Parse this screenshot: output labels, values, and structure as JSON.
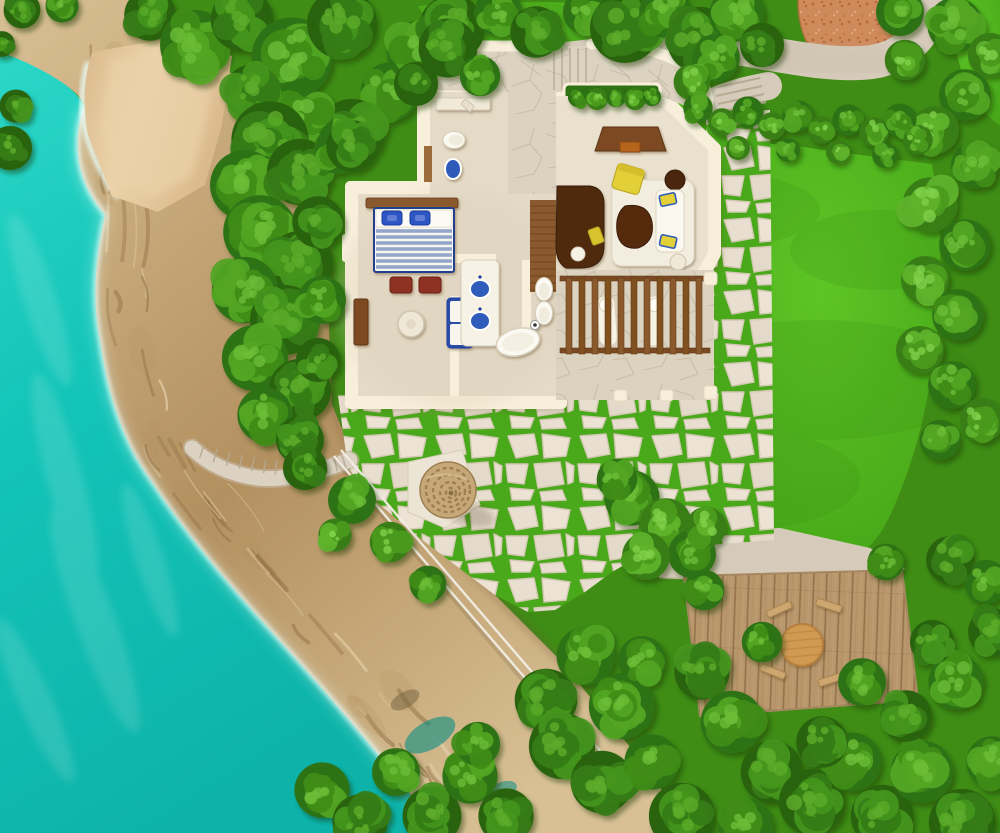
{
  "labels": {
    "scene": "aerial-villa-site-plan",
    "sea": "turquoise sea",
    "beach": "sand beach cove",
    "cliff": "rocky cliff shoreline",
    "forest": "tree canopy",
    "lawn": "green lawn",
    "gravel": "terracotta gravel court",
    "path": "concrete garden path",
    "flagstone": "flagstone walk with grass joints",
    "villa": "villa floor plan",
    "bedroom": "bedroom",
    "bathroom": "bathroom",
    "living": "living room",
    "courtyard": "entry courtyard",
    "pergola": "pergola sun deck",
    "umbrella": "thatched sun umbrella",
    "deck": "wooden dining deck",
    "stairs": "cliff stairway",
    "railing": "cliff handrail"
  },
  "palette": {
    "water-a": "#2bd7c7",
    "water-b": "#14c4b8",
    "water-c": "#0db3a9",
    "foam": "#eafffb",
    "sand-a": "#ecd2a9",
    "sand-b": "#d9b98c",
    "rock-a": "#d8c094",
    "rock-b": "#b3905f",
    "rock-dark": "#8c6b41",
    "rock-light": "#eeddbb",
    "grass-base": "#3f8d15",
    "lawn-a": "#5ec526",
    "lawn-b": "#42a115",
    "lawn-dim": "#2f7d0e",
    "joint": "#4aa81b",
    "stone": "#e8dfd0",
    "stone-edge": "#d5c9b4",
    "concrete": "#d6cbba",
    "concrete-edge": "#b7aa94",
    "terra": "#cf8a5c",
    "terra-dark": "#b4683a",
    "terra-light": "#e3a877",
    "wall-cream": "#f7efda",
    "wall-edge": "#e7dbc0",
    "floor": "#e4dac6",
    "floor-light": "#e9e0cd",
    "stonefloor": "#dcd2c0",
    "wood": "#8a5a2e",
    "wood-dark": "#633c17",
    "wood-mid": "#7b4a22",
    "plank-a": "#c19e74",
    "plank-b": "#8f6d45",
    "table-wood": "#d09a52",
    "thatch": "#c6a878",
    "thatch-ring": "#9e7f52",
    "navy": "#24418f",
    "stripe-blue": "#93a5c9",
    "pillow-blue": "#2e55c4",
    "sink-blue": "#2d5cb8",
    "fixture": "#fbfaf2",
    "fixture-edge": "#d8cfbc",
    "yellow": "#e3cf39",
    "yellow-dark": "#b7a51f",
    "ottoman": "#8d3220",
    "darkwood": "#4f2a10",
    "rug": "#f4efe1",
    "white": "#ffffff"
  },
  "trees": [
    [
      150,
      15,
      28,
      0
    ],
    [
      195,
      45,
      38,
      1
    ],
    [
      242,
      20,
      34,
      0
    ],
    [
      292,
      58,
      44,
      1
    ],
    [
      342,
      24,
      38,
      0
    ],
    [
      390,
      92,
      32,
      1
    ],
    [
      352,
      132,
      36,
      0
    ],
    [
      302,
      118,
      34,
      1
    ],
    [
      252,
      92,
      30,
      0
    ],
    [
      418,
      52,
      34,
      1
    ],
    [
      452,
      28,
      36,
      0
    ],
    [
      498,
      12,
      26,
      1
    ],
    [
      536,
      32,
      28,
      0
    ],
    [
      585,
      12,
      24,
      1
    ],
    [
      625,
      28,
      38,
      0
    ],
    [
      665,
      12,
      28,
      1
    ],
    [
      700,
      40,
      36,
      0
    ],
    [
      737,
      14,
      30,
      1
    ],
    [
      762,
      45,
      24,
      0
    ],
    [
      270,
      140,
      42,
      0
    ],
    [
      245,
      185,
      38,
      1
    ],
    [
      300,
      172,
      36,
      0
    ],
    [
      260,
      232,
      40,
      1
    ],
    [
      300,
      264,
      36,
      0
    ],
    [
      245,
      290,
      36,
      1
    ],
    [
      285,
      320,
      38,
      0
    ],
    [
      255,
      358,
      36,
      1
    ],
    [
      300,
      390,
      34,
      0
    ],
    [
      265,
      415,
      30,
      1
    ],
    [
      318,
      222,
      28,
      0
    ],
    [
      322,
      300,
      26,
      1
    ],
    [
      318,
      360,
      24,
      0
    ],
    [
      338,
      150,
      26,
      1
    ],
    [
      300,
      440,
      26,
      0
    ],
    [
      352,
      146,
      28,
      0
    ],
    [
      448,
      48,
      32,
      0
    ],
    [
      480,
      76,
      22,
      1
    ],
    [
      416,
      84,
      24,
      0
    ],
    [
      10,
      148,
      24,
      0
    ],
    [
      16,
      106,
      18,
      0
    ],
    [
      22,
      10,
      20,
      0
    ],
    [
      62,
      6,
      18,
      1
    ],
    [
      2,
      44,
      14,
      0
    ],
    [
      900,
      12,
      26,
      1
    ],
    [
      955,
      25,
      30,
      1
    ],
    [
      990,
      55,
      24,
      2
    ],
    [
      965,
      95,
      28,
      1
    ],
    [
      935,
      130,
      26,
      2
    ],
    [
      975,
      165,
      26,
      1
    ],
    [
      930,
      205,
      30,
      2
    ],
    [
      965,
      245,
      28,
      1
    ],
    [
      925,
      280,
      26,
      2
    ],
    [
      958,
      315,
      28,
      1
    ],
    [
      920,
      350,
      26,
      2
    ],
    [
      952,
      385,
      26,
      1
    ],
    [
      982,
      420,
      24,
      2
    ],
    [
      940,
      440,
      22,
      1
    ],
    [
      905,
      60,
      22,
      2
    ],
    [
      716,
      58,
      26,
      1
    ],
    [
      692,
      82,
      20,
      2
    ],
    [
      698,
      108,
      16,
      1
    ],
    [
      722,
      122,
      15,
      2
    ],
    [
      748,
      112,
      17,
      1
    ],
    [
      772,
      126,
      15,
      2
    ],
    [
      798,
      116,
      17,
      1
    ],
    [
      822,
      130,
      15,
      2
    ],
    [
      848,
      120,
      17,
      1
    ],
    [
      874,
      132,
      16,
      2
    ],
    [
      900,
      120,
      18,
      1
    ],
    [
      738,
      148,
      13,
      2
    ],
    [
      788,
      150,
      13,
      1
    ],
    [
      838,
      152,
      13,
      2
    ],
    [
      885,
      155,
      14,
      1
    ],
    [
      918,
      140,
      16,
      2
    ],
    [
      632,
      498,
      30,
      1
    ],
    [
      666,
      524,
      28,
      2
    ],
    [
      692,
      554,
      26,
      1
    ],
    [
      646,
      556,
      26,
      2
    ],
    [
      617,
      479,
      22,
      1
    ],
    [
      706,
      527,
      22,
      2
    ],
    [
      704,
      590,
      22,
      1
    ],
    [
      352,
      500,
      26,
      1
    ],
    [
      390,
      542,
      22,
      2
    ],
    [
      428,
      584,
      20,
      1
    ],
    [
      305,
      468,
      24,
      0
    ],
    [
      335,
      535,
      18,
      2
    ],
    [
      578,
      97,
      11,
      1
    ],
    [
      597,
      99,
      12,
      2
    ],
    [
      616,
      97,
      11,
      1
    ],
    [
      635,
      99,
      12,
      2
    ],
    [
      652,
      97,
      10,
      1
    ],
    [
      322,
      790,
      30,
      1
    ],
    [
      360,
      822,
      30,
      0
    ],
    [
      396,
      772,
      26,
      1
    ],
    [
      432,
      816,
      32,
      0
    ],
    [
      470,
      776,
      30,
      1
    ],
    [
      506,
      816,
      30,
      0
    ],
    [
      478,
      744,
      24,
      1
    ],
    [
      546,
      700,
      34,
      0
    ],
    [
      586,
      656,
      32,
      1
    ],
    [
      562,
      746,
      36,
      0
    ],
    [
      622,
      706,
      36,
      1
    ],
    [
      602,
      782,
      34,
      0
    ],
    [
      652,
      762,
      30,
      1
    ],
    [
      682,
      816,
      36,
      0
    ],
    [
      642,
      660,
      26,
      1
    ],
    [
      702,
      672,
      30,
      0
    ],
    [
      732,
      722,
      34,
      1
    ],
    [
      772,
      772,
      34,
      0
    ],
    [
      746,
      826,
      30,
      1
    ],
    [
      812,
      802,
      36,
      0
    ],
    [
      852,
      762,
      32,
      1
    ],
    [
      882,
      816,
      34,
      0
    ],
    [
      922,
      772,
      34,
      1
    ],
    [
      962,
      822,
      36,
      0
    ],
    [
      992,
      762,
      28,
      1
    ],
    [
      906,
      716,
      28,
      0
    ],
    [
      956,
      682,
      30,
      1
    ],
    [
      992,
      632,
      26,
      0
    ],
    [
      862,
      682,
      26,
      1
    ],
    [
      822,
      742,
      28,
      0
    ],
    [
      762,
      642,
      22,
      1
    ],
    [
      932,
      642,
      24,
      0
    ],
    [
      986,
      582,
      24,
      1
    ],
    [
      950,
      560,
      26,
      0
    ],
    [
      886,
      562,
      20,
      1
    ]
  ],
  "tree_shades": [
    [
      "#2a6410",
      "#357c14",
      "#44951c",
      "#5cab2b"
    ],
    [
      "#2f7213",
      "#3f8c18",
      "#52a524",
      "#6cbd37"
    ],
    [
      "#387d15",
      "#4a9a1e",
      "#60b32c",
      "#7fd04a"
    ]
  ],
  "rock_stripes": {
    "count": 52,
    "spine": [
      [
        78,
        45
      ],
      [
        92,
        150
      ],
      [
        90,
        260
      ],
      [
        102,
        345
      ],
      [
        122,
        425
      ],
      [
        158,
        490
      ],
      [
        215,
        565
      ],
      [
        272,
        630
      ],
      [
        330,
        698
      ],
      [
        382,
        757
      ],
      [
        428,
        815
      ]
    ]
  },
  "cliff_stairs": {
    "p0": [
      350,
      460
    ],
    "p1": [
      292,
      482
    ],
    "p2": [
      192,
      448
    ],
    "ticks": 14
  },
  "railing": {
    "a": [
      334,
      456
    ],
    "b": [
      630,
      800
    ],
    "offset": 7
  },
  "umbrella": {
    "cx": 448,
    "cy": 490,
    "r": 28
  },
  "deck_table": {
    "cx": 802,
    "cy": 645,
    "r": 21
  }
}
